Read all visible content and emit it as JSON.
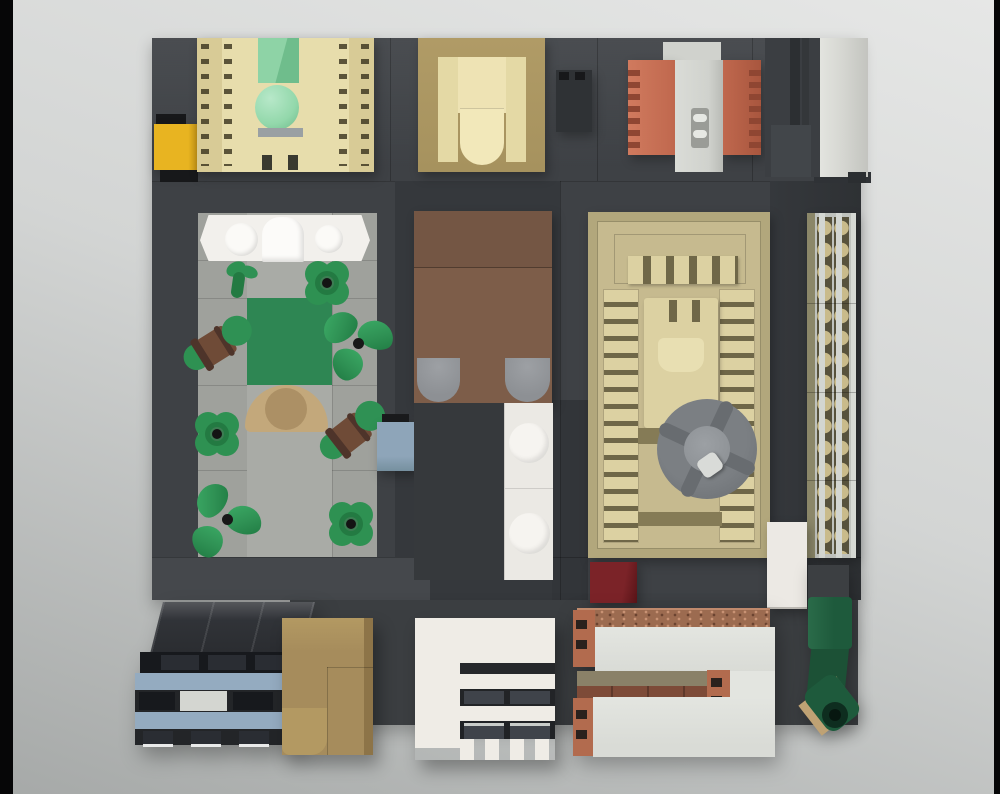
{
  "scene": {
    "type": "lego-top-down-render",
    "description": "Top-down 3D render of a LEGO modular interior/street layout on a dark gray baseplate, over a light gray studio backdrop with black bars at the left and right image edges."
  },
  "palette": {
    "bgTop": "#e6e7e6",
    "bgMid": "#d3d5d4",
    "bgLow": "#a6a9a8",
    "barBlack": "#060607",
    "plate": "#3e4145",
    "plateTop": "#4a4d51",
    "plateDark": "#35383c",
    "plateDeep": "#323539",
    "plateExt": "#3b3e41",
    "plateWalk": "#45484c",
    "ledge": "#2f3236",
    "tan": "#d8cb96",
    "tanLight": "#e7ddac",
    "tanDark": "#a6925e",
    "cream": "#eee3b4",
    "greenPillow": "#8ed3a6",
    "greenPillowSide": "#6fbd8c",
    "greenBall": "#93d8ab",
    "grayStripe": "#9aa0a3",
    "yellow": "#e8b421",
    "black": "#17181a",
    "orange": "#c0684e",
    "orangeSlot": "#8f4632",
    "chimGray": "#d0d2cd",
    "ventGray": "#9a9c97",
    "ventBar": "#e6e8e3",
    "cabinet": "#3b3e42",
    "cabinetStripe": "#2c2f32",
    "panelGray": "#d6d7d2",
    "patio": "#9fa19c",
    "patioLight": "#a9aba6",
    "white": "#f2f0ec",
    "rug": "#2e8653",
    "plantGreen": "#2e9152",
    "plantGreenDark": "#237a42",
    "leafGreen": "#2f9154",
    "potBrown": "#6f4b37",
    "potBand": "#4e342a",
    "tableTan": "#c3a87b",
    "tableTanDark": "#ac9065",
    "benchBlue": "#8ea5b9",
    "bedBrown": "#7d5d49",
    "bedBrownDark": "#745644",
    "pillowGray": "#8d9094",
    "underBed": "#36393c",
    "tileWhite": "#ebe9e4",
    "tileCircle": "#f6f4f0",
    "templeBase": "#b2a77c",
    "templeInner": "#c6ba8f",
    "templeLight": "#dcd1a2",
    "templeSlot": "#6f6748",
    "templeShade": "#857b56",
    "fanGray": "#7b7f83",
    "fanDark": "#686c70",
    "fanHub": "#8a8e92",
    "fanStud": "#d9dbd8",
    "redBrick": "#7b2328",
    "redBrickDark": "#591418",
    "convFrame": "#bfc2bd",
    "convRail": "#d3d6d1",
    "convSlot": "#57523c",
    "convDisc": "#c9bb8b",
    "convOlive": "#8b8769",
    "slabWhite": "#d9dbd6",
    "slabWhite2": "#e3e5e0",
    "copper": "#b26b4e",
    "copperDark": "#8a4a33",
    "slotDark": "#2a211d",
    "speckle": "#9c6b50",
    "recessOlive": "#8a8168",
    "brickRow": "#7d4b38",
    "aptRoof": "#2a2c30",
    "aptFace": "#232528",
    "aptBlue": "#94abc0",
    "winDark": "#17191d",
    "winGloss": "#2a2d33",
    "winLight": "#d4d6d1",
    "sill": "#e9eaea",
    "tanBldg": "#a68c5c",
    "tanBldgLight": "#b39962",
    "tanBldgDark": "#8d7448",
    "whiteBldg": "#efece6",
    "rowDark": "#26282b",
    "winGray": "#3f434a",
    "cannonGreen": "#1e5a3c",
    "cannonGreen2": "#1c5136",
    "cannonDark": "#0e2d1f",
    "wedgeTan": "#bfa274",
    "whiteSlab": "#ece9e4"
  },
  "modules": [
    {
      "id": "bedroom",
      "label": "Tan bed module with green pillow, green ball and notched nightstands"
    },
    {
      "id": "yellow-brick",
      "label": "Yellow brick with black bricks"
    },
    {
      "id": "armchair",
      "label": "Cream armchair on dark tan base"
    },
    {
      "id": "utility-box",
      "label": "Small dark gray box with studs"
    },
    {
      "id": "fireplace",
      "label": "Terracotta fireplace with gray chimney column"
    },
    {
      "id": "cabinet",
      "label": "Dark gray cabinet with light gray door panel"
    },
    {
      "id": "garden",
      "label": "Patio garden with white table, plants, flowers, green rug and round tan table"
    },
    {
      "id": "bench",
      "label": "Sand-blue bench piece"
    },
    {
      "id": "brown-bed",
      "label": "Brown bed with two gray pillows"
    },
    {
      "id": "tile-path",
      "label": "White tile path with two round tiles"
    },
    {
      "id": "temple",
      "label": "Tan castle-like structure with gray four-spoke wheel"
    },
    {
      "id": "red-brick",
      "label": "Dark red brick"
    },
    {
      "id": "conveyor",
      "label": "Light gray rail strip with stacked tan discs"
    },
    {
      "id": "white-slab",
      "label": "Small white slab"
    },
    {
      "id": "apartment",
      "label": "Dark apartment block with sand-blue stripes and windows"
    },
    {
      "id": "tan-building",
      "label": "Dark tan L-shaped building"
    },
    {
      "id": "white-building",
      "label": "White building with dark window rows and crenellated edge"
    },
    {
      "id": "masonry",
      "label": "Masonry kiln with light gray slabs and copper bricks"
    },
    {
      "id": "cannon",
      "label": "Dark green cannon piece"
    }
  ]
}
